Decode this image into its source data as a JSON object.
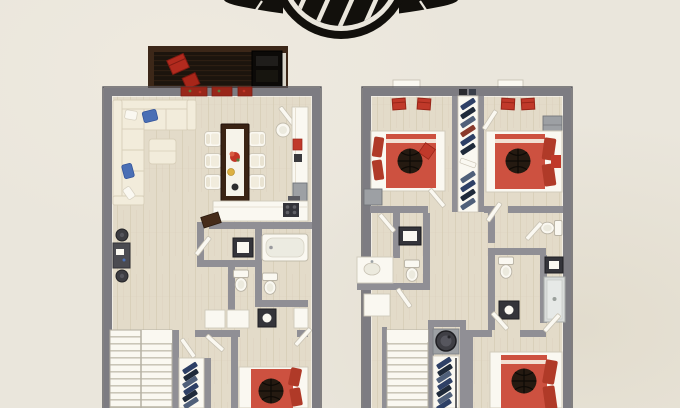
{
  "scene": {
    "label": "two-storey-3d-floor-plan-sheet"
  },
  "logo": {
    "name": "winged-basketball-emblem",
    "color": "#12100c",
    "ring_color": "#12100c",
    "seam_color": "#eae6dc"
  },
  "palette": {
    "bg": "#eae6dc",
    "bg_shade": "#ded9cb",
    "wall": "#7d7c82",
    "wall_light": "#908f95",
    "wall_dark": "#55545a",
    "floor": "#e3dbc9",
    "floor_line": "#d2c8b1",
    "deck": "#1c140d",
    "deck_frame": "#3c2718",
    "deck_line": "#2d1e12",
    "white": "#faf8f1",
    "white_line": "#cfc9ba",
    "cream": "#f2ecdb",
    "cream_line": "#d8cfba",
    "red": "#c0392a",
    "red_dark": "#992619",
    "bed_red": "#cd5140",
    "bed_red_dark": "#b03a28",
    "blue": "#4a6fb5",
    "navy": "#2e4066",
    "navy_dark": "#1f2a3a",
    "navy_light": "#50607a",
    "wood_dark": "#3a2314",
    "ball": "#251a11",
    "ball_line": "#0e0a06",
    "black": "#12100c",
    "appliance": "#9da0a4",
    "appliance_dark": "#34343a",
    "shower": "#d9dcda",
    "stair_line": "#c8c3b5",
    "yellow": "#ddb042",
    "flower_red": "#c23527",
    "green": "#5a7a3a"
  },
  "floor_plans": [
    {
      "id": "main-floor-plan",
      "position": "left",
      "rooms": [
        "deck",
        "living-room",
        "dining-area",
        "kitchen",
        "bathroom",
        "powder-room",
        "hallway",
        "staircase",
        "closet",
        "bedroom"
      ],
      "furniture": [
        "deck-lounge-chairs",
        "grill",
        "sectional-sofa",
        "ottoman",
        "dining-table",
        "dining-chairs",
        "kitchen-counter",
        "stove",
        "bathtub",
        "dark-vanity",
        "toilets",
        "wall-desk",
        "stools",
        "shelf-closet",
        "basketball-bed"
      ]
    },
    {
      "id": "bedroom-floor-plan",
      "position": "right",
      "rooms": [
        "bedroom-1",
        "bedroom-2",
        "bedroom-3",
        "walk-in-closet",
        "bathroom-1",
        "bathroom-2",
        "bathroom-3",
        "hallway",
        "staircase",
        "laundry-closet"
      ],
      "furniture": [
        "basketball-bed-1",
        "basketball-bed-2",
        "basketball-bed-3",
        "window-seats",
        "dresser",
        "nightstand",
        "toilets",
        "sinks",
        "shower",
        "washing-machine",
        "shoe-shelves"
      ]
    }
  ]
}
